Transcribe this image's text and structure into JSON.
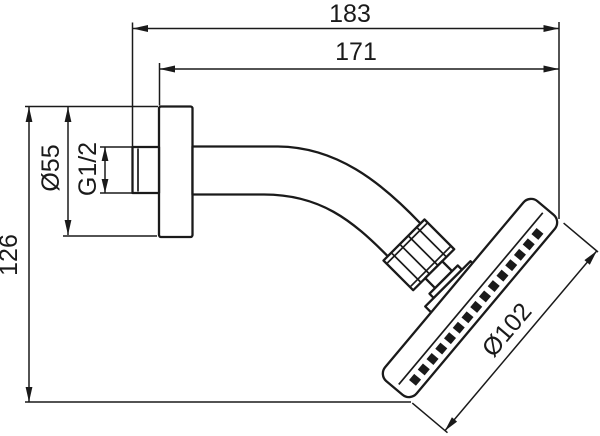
{
  "drawing": {
    "background": "#ffffff",
    "line_color": "#1a1a1a",
    "dimensions": {
      "total_projection": "183",
      "projection_from_plate": "171",
      "plate_diameter": "Ø55",
      "thread_size": "G1/2",
      "height": "126",
      "head_diameter": "Ø102"
    }
  }
}
